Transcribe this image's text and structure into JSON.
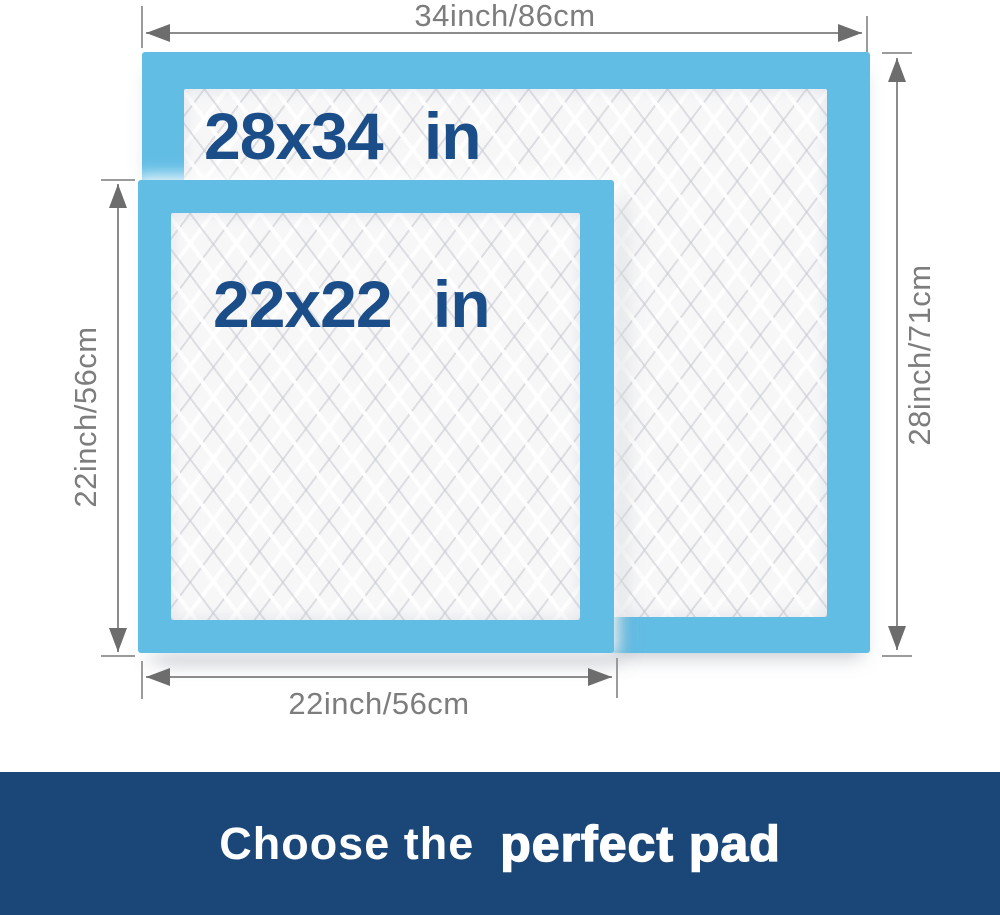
{
  "colors": {
    "pad_border_blue": "#62bde5",
    "pad_surface_white": "#f7f7f8",
    "size_label_navy": "#1b4d88",
    "dimension_gray": "#7d7d7d",
    "banner_background_navy": "#1a4778",
    "banner_text_white": "#ffffff"
  },
  "pads": {
    "large": {
      "size_label": "28x34 in",
      "width_dimension": "34inch/86cm",
      "height_dimension": "28inch/71cm"
    },
    "small": {
      "size_label": "22x22 in",
      "width_dimension": "22inch/56cm",
      "height_dimension": "22inch/56cm"
    }
  },
  "banner": {
    "lead_text": "Choose the",
    "emphasis_text": "perfect pad"
  }
}
